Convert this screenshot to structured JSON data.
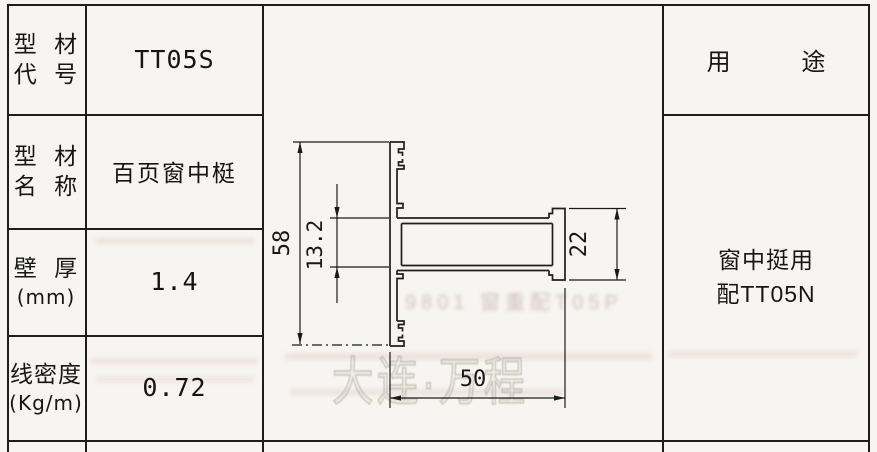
{
  "spec_table": {
    "rows": [
      {
        "label_line1": "型 材",
        "label_line2": "代 号",
        "value": "TT05S"
      },
      {
        "label_line1": "型 材",
        "label_line2": "名 称",
        "value": "百页窗中梃"
      },
      {
        "label_line1": "壁 厚",
        "label_line2": "(mm)",
        "value": "1.4"
      },
      {
        "label_line1": "线密度",
        "label_line2": "(Kg/m)",
        "value": "0.72"
      }
    ]
  },
  "usage": {
    "header": "用 途",
    "line1": "窗中挺用",
    "line2": "配TT05N"
  },
  "drawing": {
    "type": "aluminum-profile-cross-section",
    "dims": {
      "overall_height": "58",
      "web_height": "13.2",
      "end_height": "22",
      "overall_width": "50"
    }
  },
  "watermark": {
    "outline_text": "大连·万程",
    "bleed_text": "9801 窗重配T05P"
  }
}
